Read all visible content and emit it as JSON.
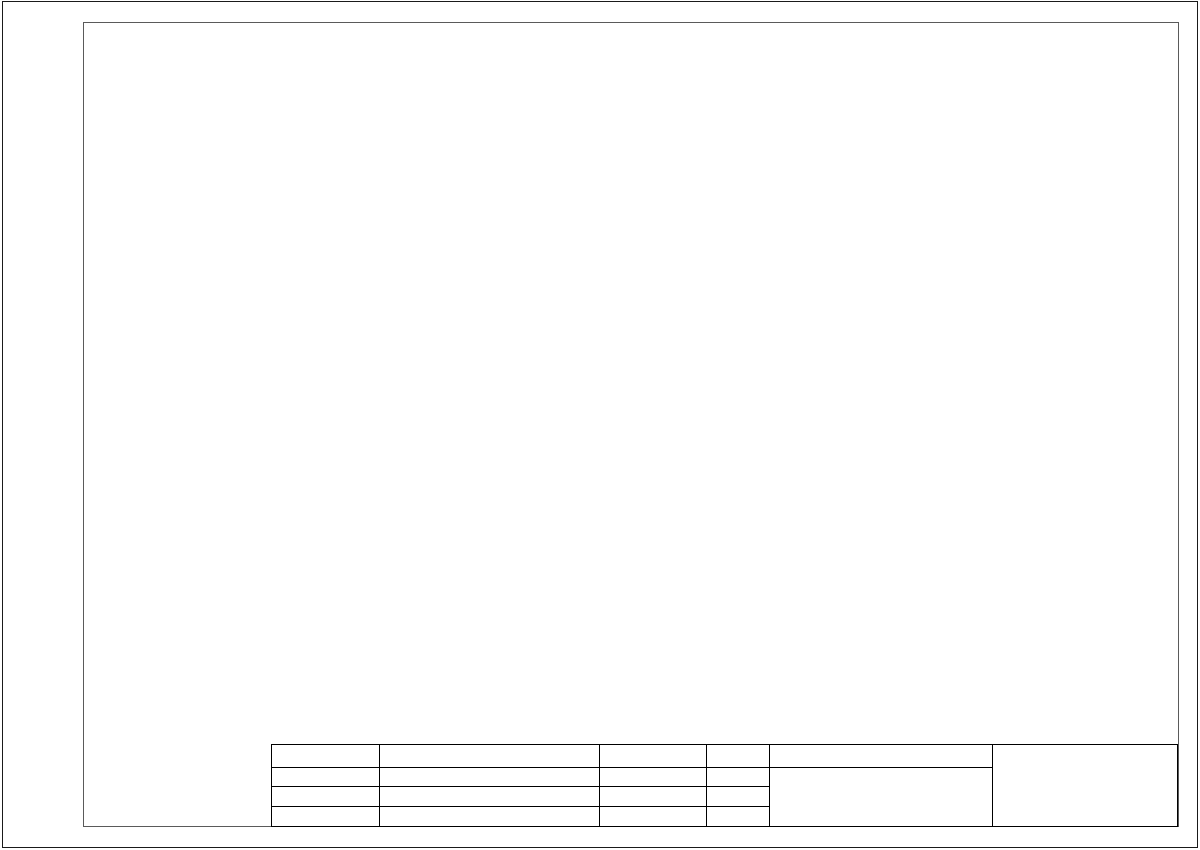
{
  "page": {
    "bg": "#ffffff",
    "border_color": "#1a1a1a",
    "frame_color": "#5a5a5a",
    "line_color": "#2b2b2b",
    "dark_fill": "#161616",
    "dim_color": "#3c3c3c"
  },
  "plan_view": {
    "dim_top": {
      "label": "6000 mm",
      "x1": 180,
      "x2": 490,
      "y": 52
    },
    "dim_left": {
      "label": "8000 mm",
      "x": 133,
      "y1": 66,
      "y2": 496,
      "label_x": 128,
      "label_y": 284
    },
    "room": {
      "outer": [
        178,
        73,
        313,
        418
      ],
      "inner": [
        183,
        78,
        303,
        408
      ]
    },
    "wall_panels": [
      {
        "x1": 222,
        "x2": 318
      },
      {
        "x1": 345,
        "x2": 436
      }
    ],
    "desks": [
      {
        "x": 250,
        "y": 77,
        "w": 42,
        "h": 83,
        "dots": "left"
      },
      {
        "x": 388,
        "y": 77,
        "w": 42,
        "h": 83,
        "dots": "left"
      },
      {
        "x": 183,
        "y": 212,
        "w": 80,
        "h": 45,
        "dots": "bottom"
      },
      {
        "x": 183,
        "y": 353,
        "w": 80,
        "h": 42,
        "dots": "bottom"
      }
    ],
    "chairs": [
      {
        "x": 216,
        "y": 98,
        "w": 31,
        "h": 37,
        "facing": "right"
      },
      {
        "x": 293,
        "y": 98,
        "w": 30,
        "h": 37,
        "facing": "left"
      },
      {
        "x": 355,
        "y": 98,
        "w": 32,
        "h": 37,
        "facing": "right"
      },
      {
        "x": 432,
        "y": 98,
        "w": 30,
        "h": 37,
        "facing": "left"
      },
      {
        "x": 195,
        "y": 175,
        "w": 33,
        "h": 37,
        "facing": "down"
      },
      {
        "x": 195,
        "y": 257,
        "w": 33,
        "h": 31,
        "facing": "up"
      },
      {
        "x": 195,
        "y": 320,
        "w": 33,
        "h": 32,
        "facing": "down"
      },
      {
        "x": 195,
        "y": 395,
        "w": 33,
        "h": 32,
        "facing": "up"
      }
    ]
  },
  "iso_view": {
    "floor": {
      "outer": [
        [
          821,
          360
        ],
        [
          1158,
          512
        ],
        [
          773,
          737
        ],
        [
          487,
          580
        ]
      ],
      "inset": 0.97
    },
    "rails": [
      {
        "p1": [
          829,
          374
        ],
        "p2": [
          508,
          585
        ]
      },
      {
        "p1": [
          818,
          371
        ],
        "p2": [
          1146,
          519
        ]
      }
    ],
    "dims": [
      {
        "label": "8000 mm",
        "p1": [
          452,
          554
        ],
        "p2": [
          818,
          344
        ],
        "lx": 638,
        "ly": 450
      },
      {
        "label": "6000 mm",
        "p1": [
          818,
          344
        ],
        "p2": [
          1162,
          510
        ],
        "lx": 1026,
        "ly": 431
      }
    ],
    "ext_lines": [
      [
        [
          487,
          580
        ],
        [
          449,
          557
        ]
      ],
      [
        [
          821,
          362
        ],
        [
          816,
          342
        ]
      ],
      [
        [
          1158,
          512
        ],
        [
          1168,
          509
        ]
      ]
    ],
    "items": [
      {
        "t": "chair",
        "x": 865,
        "y": 390,
        "back": "-A"
      },
      {
        "t": "chair",
        "x": 795,
        "y": 419,
        "back": "-B"
      },
      {
        "t": "desk",
        "x": 906,
        "y": 398,
        "axis": "B"
      },
      {
        "t": "chair",
        "x": 950,
        "y": 456,
        "back": "+A"
      },
      {
        "t": "desk",
        "x": 761,
        "y": 438,
        "axis": "A"
      },
      {
        "t": "chair",
        "x": 719,
        "y": 477,
        "back": "+B"
      },
      {
        "t": "chair",
        "x": 1001,
        "y": 466,
        "back": "-A"
      },
      {
        "t": "desk",
        "x": 1032,
        "y": 468,
        "axis": "B"
      },
      {
        "t": "chair",
        "x": 665,
        "y": 491,
        "back": "-B"
      },
      {
        "t": "desk",
        "x": 638,
        "y": 508,
        "axis": "A"
      },
      {
        "t": "chair",
        "x": 594,
        "y": 552,
        "back": "+B"
      },
      {
        "t": "chair",
        "x": 1070,
        "y": 521,
        "back": "+A"
      }
    ]
  },
  "title_block": {
    "signature_header": "Подпись",
    "date_header": "Дата",
    "furniture_set_header": "Комплект мебели",
    "customer_label": "Заказчик",
    "manager_label": "Менеджер",
    "company": {
      "name": "ООО «Нарбутас»",
      "phone": "Тел.:8-800-250-84-80",
      "country": "(Россия)"
    }
  }
}
